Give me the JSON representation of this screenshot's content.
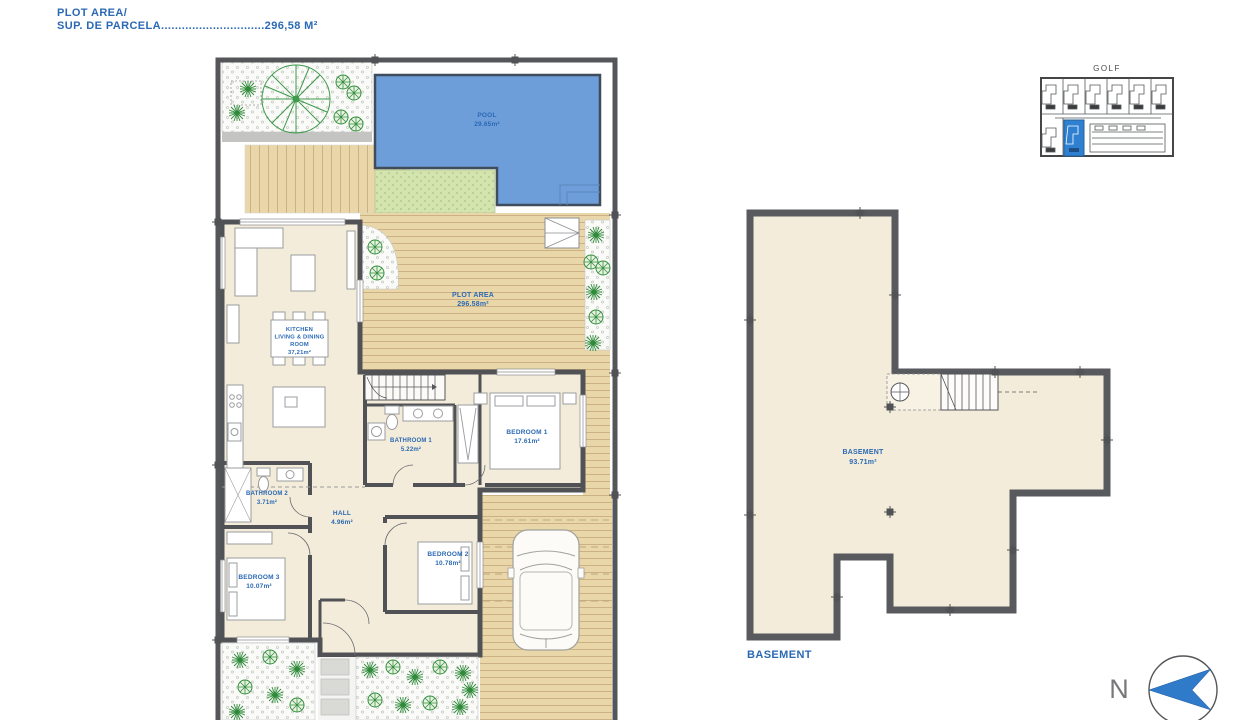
{
  "header": {
    "line1": "PLOT AREA/",
    "line2": "SUP. DE PARCELA..............................296,58 M²"
  },
  "ground_floor": {
    "pool": {
      "name": "POOL",
      "area": "29.65m²"
    },
    "plot": {
      "name": "PLOT AREA",
      "area": "296.58m²"
    },
    "kitchen": {
      "line1": "KITCHEN",
      "line2": "LIVING & DINING",
      "line3": "ROOM",
      "area": "37,21m²"
    },
    "bathroom1": {
      "name": "BATHROOM 1",
      "area": "5.22m²"
    },
    "bedroom1": {
      "name": "BEDROOM 1",
      "area": "17.61m²"
    },
    "bathroom2": {
      "name": "BATHROOM 2",
      "area": "3.71m²"
    },
    "hall": {
      "name": "HALL",
      "area": "4.96m²"
    },
    "bedroom2": {
      "name": "BEDROOM 2",
      "area": "10.78m²"
    },
    "bedroom3": {
      "name": "BEDROOM 3",
      "area": "10.07m²"
    }
  },
  "basement": {
    "name": "BASEMENT",
    "area": "93.71m²",
    "caption": "BASEMENT"
  },
  "key_map": {
    "title": "GOLF"
  },
  "compass": {
    "label": "N"
  },
  "colors": {
    "label_blue": "#2b69b4",
    "pool_blue": "#6d9ed9",
    "deck_tan": "#ead7a9",
    "turf_green": "#d4e4ae",
    "floor_cream": "#f3ecda",
    "wall_gray": "#55565a",
    "highlight_blue": "#2f80d0"
  }
}
